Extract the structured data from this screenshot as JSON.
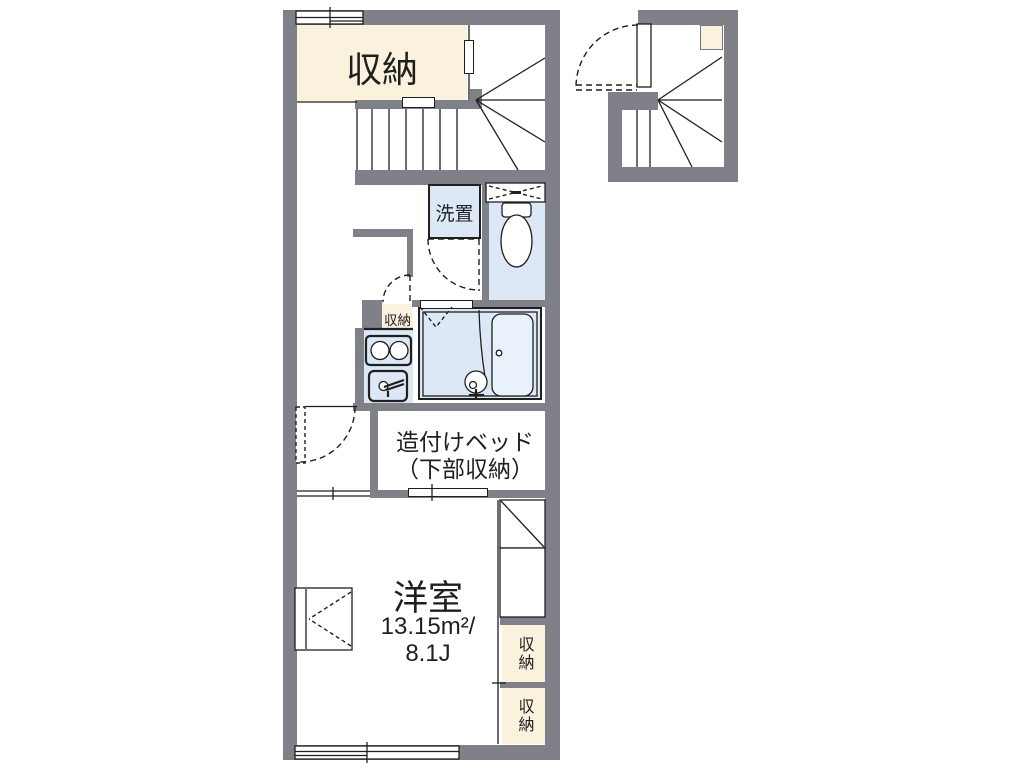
{
  "labels": {
    "storage_top": "収納",
    "washer": "洗置",
    "hall_closet": "収納",
    "bed_line1": "造付けベッド",
    "bed_line2": "（下部収納）",
    "room_name": "洋室",
    "room_area_m2": "13.15m²/",
    "room_area_jo": "8.1J",
    "storage_right_top": "収納",
    "storage_right_bottom": "収納"
  },
  "colors": {
    "wall": "#808089",
    "storage_fill": "#fbf2dd",
    "wet_fill": "#dde8f7",
    "line": "#1f1f1f",
    "background": "#ffffff"
  }
}
